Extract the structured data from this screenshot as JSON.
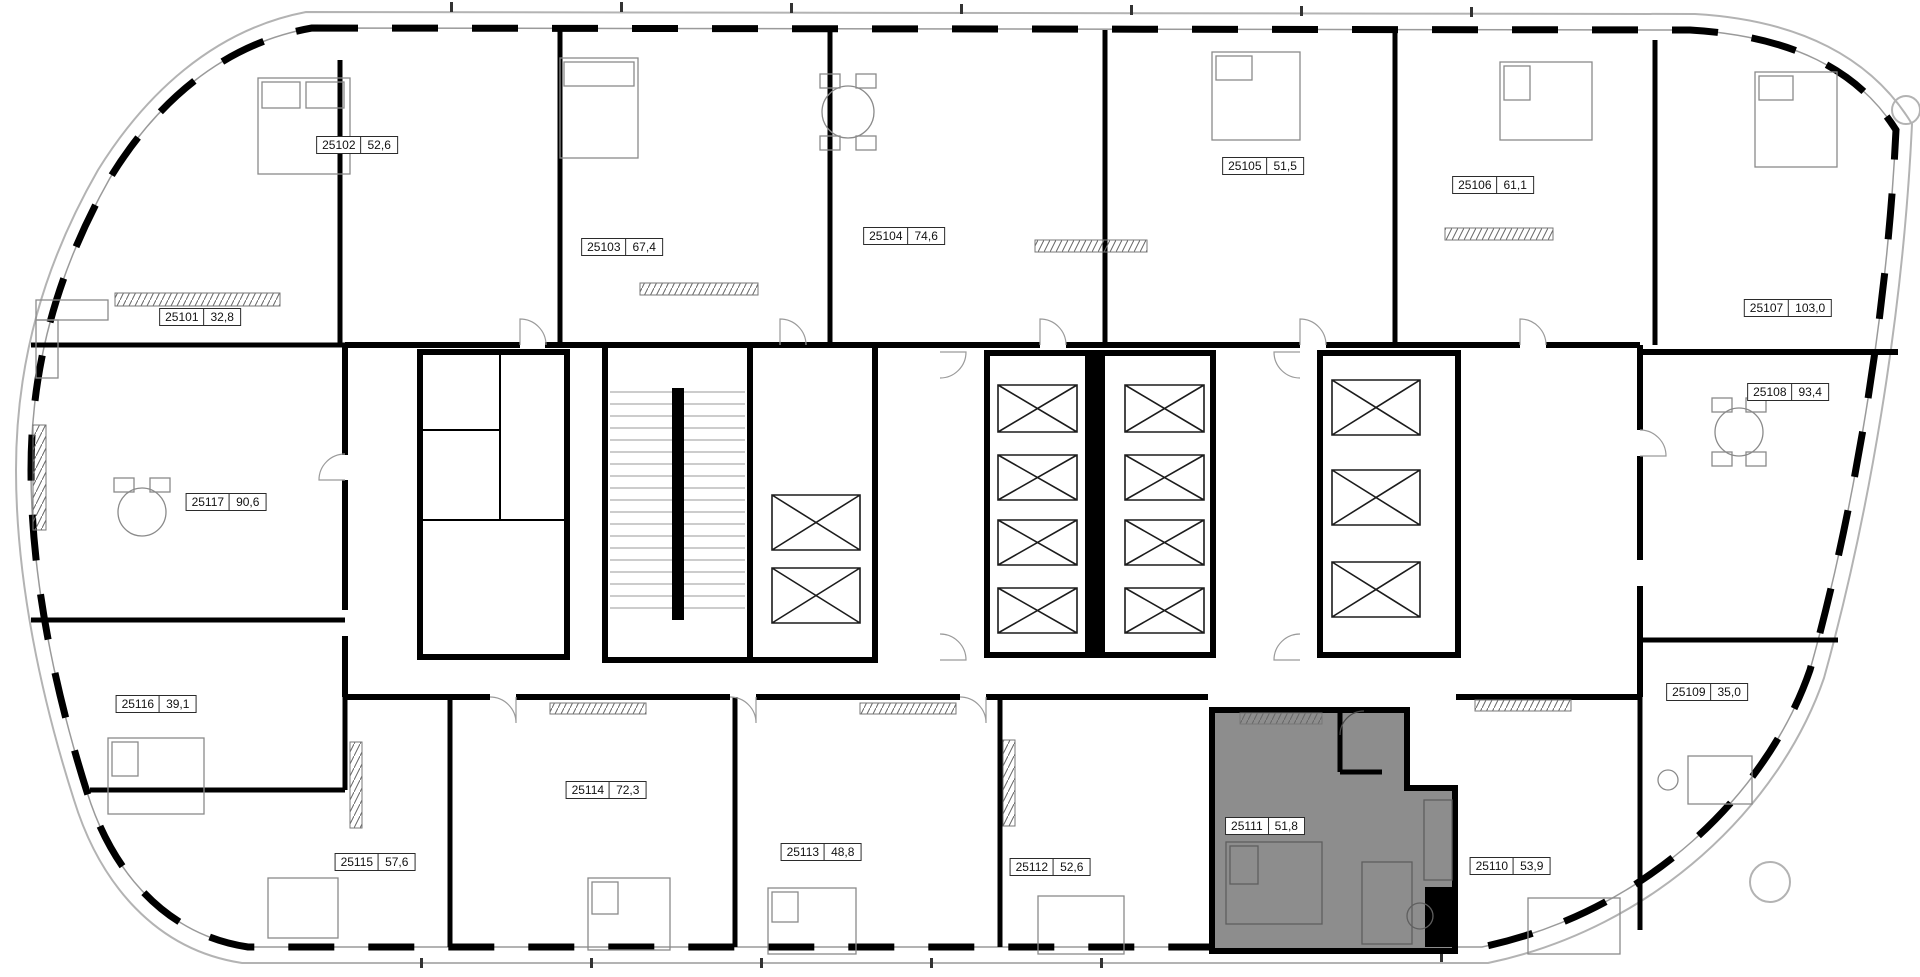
{
  "floor_plan": {
    "type": "residential-floor-plan",
    "highlighted_unit_id": "25111",
    "units": [
      {
        "id": "25101",
        "area": "32,8",
        "label_x": 200,
        "label_y": 317
      },
      {
        "id": "25102",
        "area": "52,6",
        "label_x": 357,
        "label_y": 145
      },
      {
        "id": "25103",
        "area": "67,4",
        "label_x": 622,
        "label_y": 247
      },
      {
        "id": "25104",
        "area": "74,6",
        "label_x": 904,
        "label_y": 236
      },
      {
        "id": "25105",
        "area": "51,5",
        "label_x": 1263,
        "label_y": 166
      },
      {
        "id": "25106",
        "area": "61,1",
        "label_x": 1493,
        "label_y": 185
      },
      {
        "id": "25107",
        "area": "103,0",
        "label_x": 1788,
        "label_y": 308
      },
      {
        "id": "25108",
        "area": "93,4",
        "label_x": 1788,
        "label_y": 392
      },
      {
        "id": "25109",
        "area": "35,0",
        "label_x": 1707,
        "label_y": 692
      },
      {
        "id": "25110",
        "area": "53,9",
        "label_x": 1510,
        "label_y": 866
      },
      {
        "id": "25111",
        "area": "51,8",
        "label_x": 1265,
        "label_y": 826
      },
      {
        "id": "25112",
        "area": "52,6",
        "label_x": 1050,
        "label_y": 867
      },
      {
        "id": "25113",
        "area": "48,8",
        "label_x": 821,
        "label_y": 852
      },
      {
        "id": "25114",
        "area": "72,3",
        "label_x": 606,
        "label_y": 790
      },
      {
        "id": "25115",
        "area": "57,6",
        "label_x": 375,
        "label_y": 862
      },
      {
        "id": "25116",
        "area": "39,1",
        "label_x": 156,
        "label_y": 704
      },
      {
        "id": "25117",
        "area": "90,6",
        "label_x": 226,
        "label_y": 502
      }
    ],
    "colors": {
      "background": "#ffffff",
      "walls": "#000000",
      "outline": "#b3b3b3",
      "highlight_fill": "#8d8d8d",
      "label_border": "#2b2b2b",
      "thin_lines": "#8a8a8a"
    }
  }
}
